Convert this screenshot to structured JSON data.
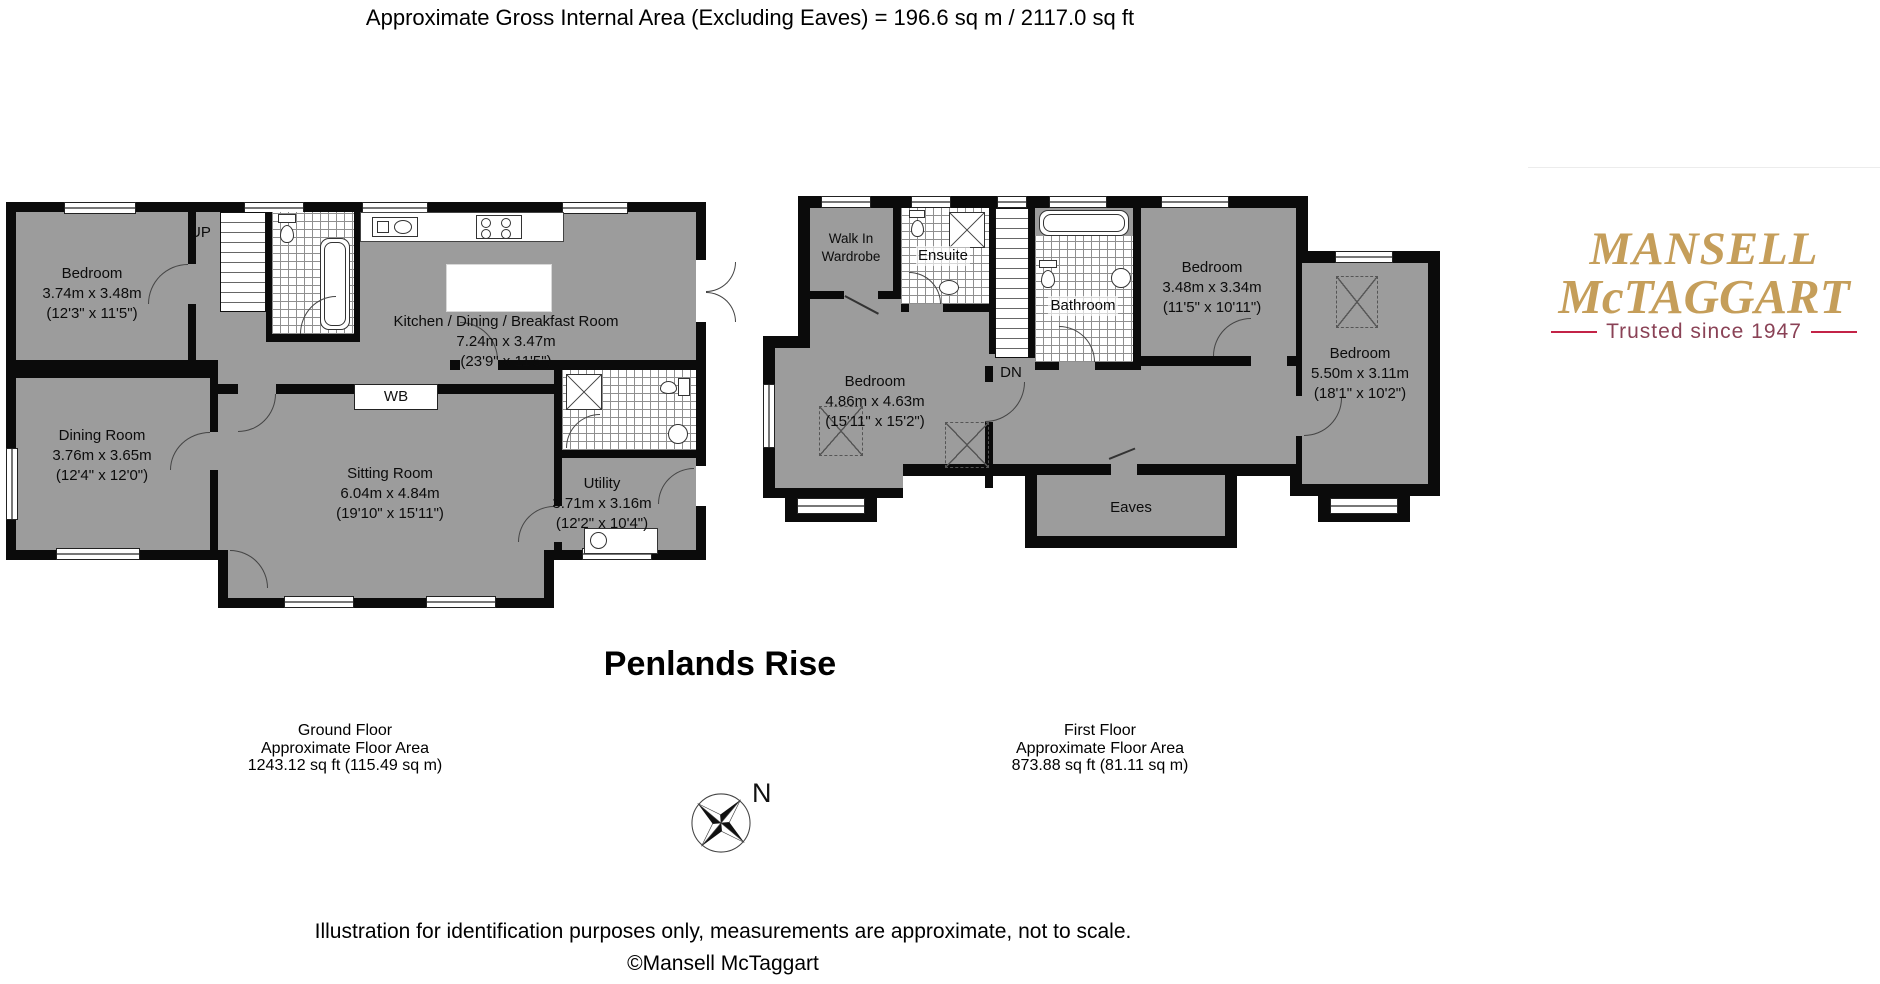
{
  "header": {
    "title": "Approximate Gross Internal Area (Excluding Eaves) = 196.6 sq m / 2117.0 sq ft"
  },
  "property": {
    "name": "Penlands Rise"
  },
  "ground_floor": {
    "rooms": {
      "bedroom": {
        "name": "Bedroom",
        "metric": "3.74m x 3.48m",
        "imperial": "(12'3\" x 11'5\")"
      },
      "dining_room": {
        "name": "Dining Room",
        "metric": "3.76m x 3.65m",
        "imperial": "(12'4\" x 12'0\")"
      },
      "kitchen": {
        "name": "Kitchen / Dining / Breakfast Room",
        "metric": "7.24m x 3.47m",
        "imperial": "(23'9\" x 11'5\")"
      },
      "sitting_room": {
        "name": "Sitting Room",
        "metric": "6.04m x 4.84m",
        "imperial": "(19'10\" x 15'11\")"
      },
      "utility": {
        "name": "Utility",
        "metric": "3.71m x 3.16m",
        "imperial": "(12'2\" x 10'4\")"
      }
    },
    "labels": {
      "up": "UP",
      "wb": "WB"
    },
    "caption": {
      "floor": "Ground Floor",
      "area_label": "Approximate Floor Area",
      "area_value": "1243.12 sq ft (115.49 sq m)"
    }
  },
  "first_floor": {
    "rooms": {
      "walk_in_wardrobe": {
        "name": "Walk In Wardrobe"
      },
      "ensuite": {
        "name": "Ensuite"
      },
      "bathroom": {
        "name": "Bathroom"
      },
      "bedroom_main": {
        "name": "Bedroom",
        "metric": "4.86m x 4.63m",
        "imperial": "(15'11\" x 15'2\")"
      },
      "bedroom_mid": {
        "name": "Bedroom",
        "metric": "3.48m x 3.34m",
        "imperial": "(11'5\" x 10'11\")"
      },
      "bedroom_long": {
        "name": "Bedroom",
        "metric": "5.50m x 3.11m",
        "imperial": "(18'1\" x 10'2\")"
      },
      "eaves": {
        "name": "Eaves"
      }
    },
    "labels": {
      "dn": "DN"
    },
    "caption": {
      "floor": "First Floor",
      "area_label": "Approximate Floor Area",
      "area_value": "873.88 sq ft (81.11 sq m)"
    }
  },
  "compass": {
    "north_label": "N"
  },
  "notes": {
    "disclaimer": "Illustration for identification purposes only, measurements are approximate, not to scale.",
    "copyright": "©Mansell McTaggart"
  },
  "logo": {
    "name_line1": "MANSELL",
    "name_line2": "McTAGGART",
    "tagline": "Trusted since 1947",
    "colors": {
      "gold": "#c59e5a",
      "maroon": "#8a4256",
      "crimson": "#c32347"
    }
  },
  "plan_colors": {
    "room_fill": "#9c9c9c"
  }
}
